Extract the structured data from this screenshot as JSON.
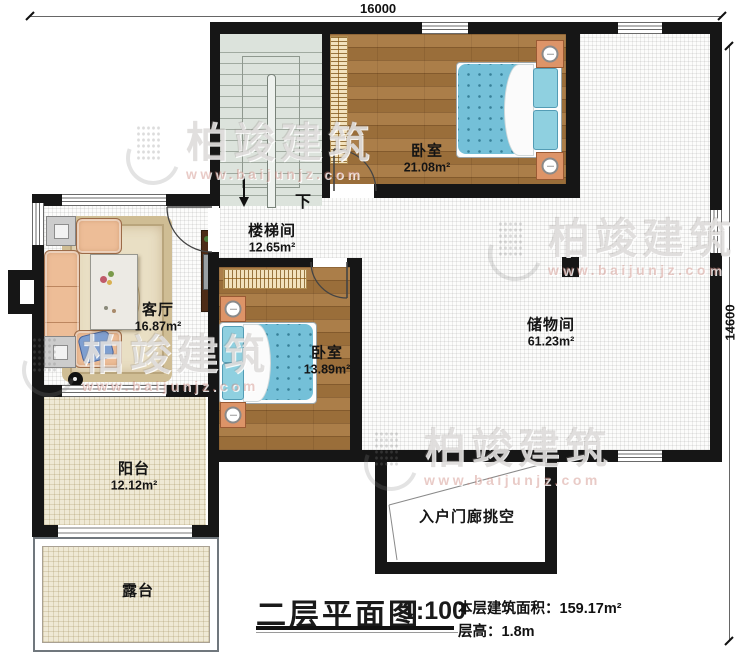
{
  "watermark": {
    "brand": "柏竣建筑",
    "website": "www.baijunjz.com"
  },
  "dimensions": {
    "top_width": "16000",
    "right_height": "14600"
  },
  "plan": {
    "stair_down": "下",
    "rooms": [
      {
        "name": "卧室",
        "area": "21.08m²"
      },
      {
        "name": "楼梯间",
        "area": "12.65m²"
      },
      {
        "name": "客厅",
        "area": "16.87m²"
      },
      {
        "name": "卧室",
        "area": "13.89m²"
      },
      {
        "name": "储物间",
        "area": "61.23m²"
      },
      {
        "name": "阳台",
        "area": "12.12m²"
      },
      {
        "name": "露台",
        "area": ""
      },
      {
        "name": "入户门廊挑空",
        "area": ""
      }
    ]
  },
  "title_block": {
    "title": "二层平面图",
    "scale": "1:100",
    "floor_area_label": "本层建筑面积：",
    "floor_area_value": "159.17m²",
    "floor_height_label": "层高：",
    "floor_height_value": "1.8m"
  },
  "colors": {
    "wall": "#161616",
    "wood_floor": "#a6763e",
    "stair_floor": "#dce3dc",
    "balcony_floor": "#efe9d5",
    "mattress": "#74c0d8",
    "nightstand": "#dd9468",
    "sofa": "#edbd97",
    "watermark_red": "#c87c74"
  }
}
